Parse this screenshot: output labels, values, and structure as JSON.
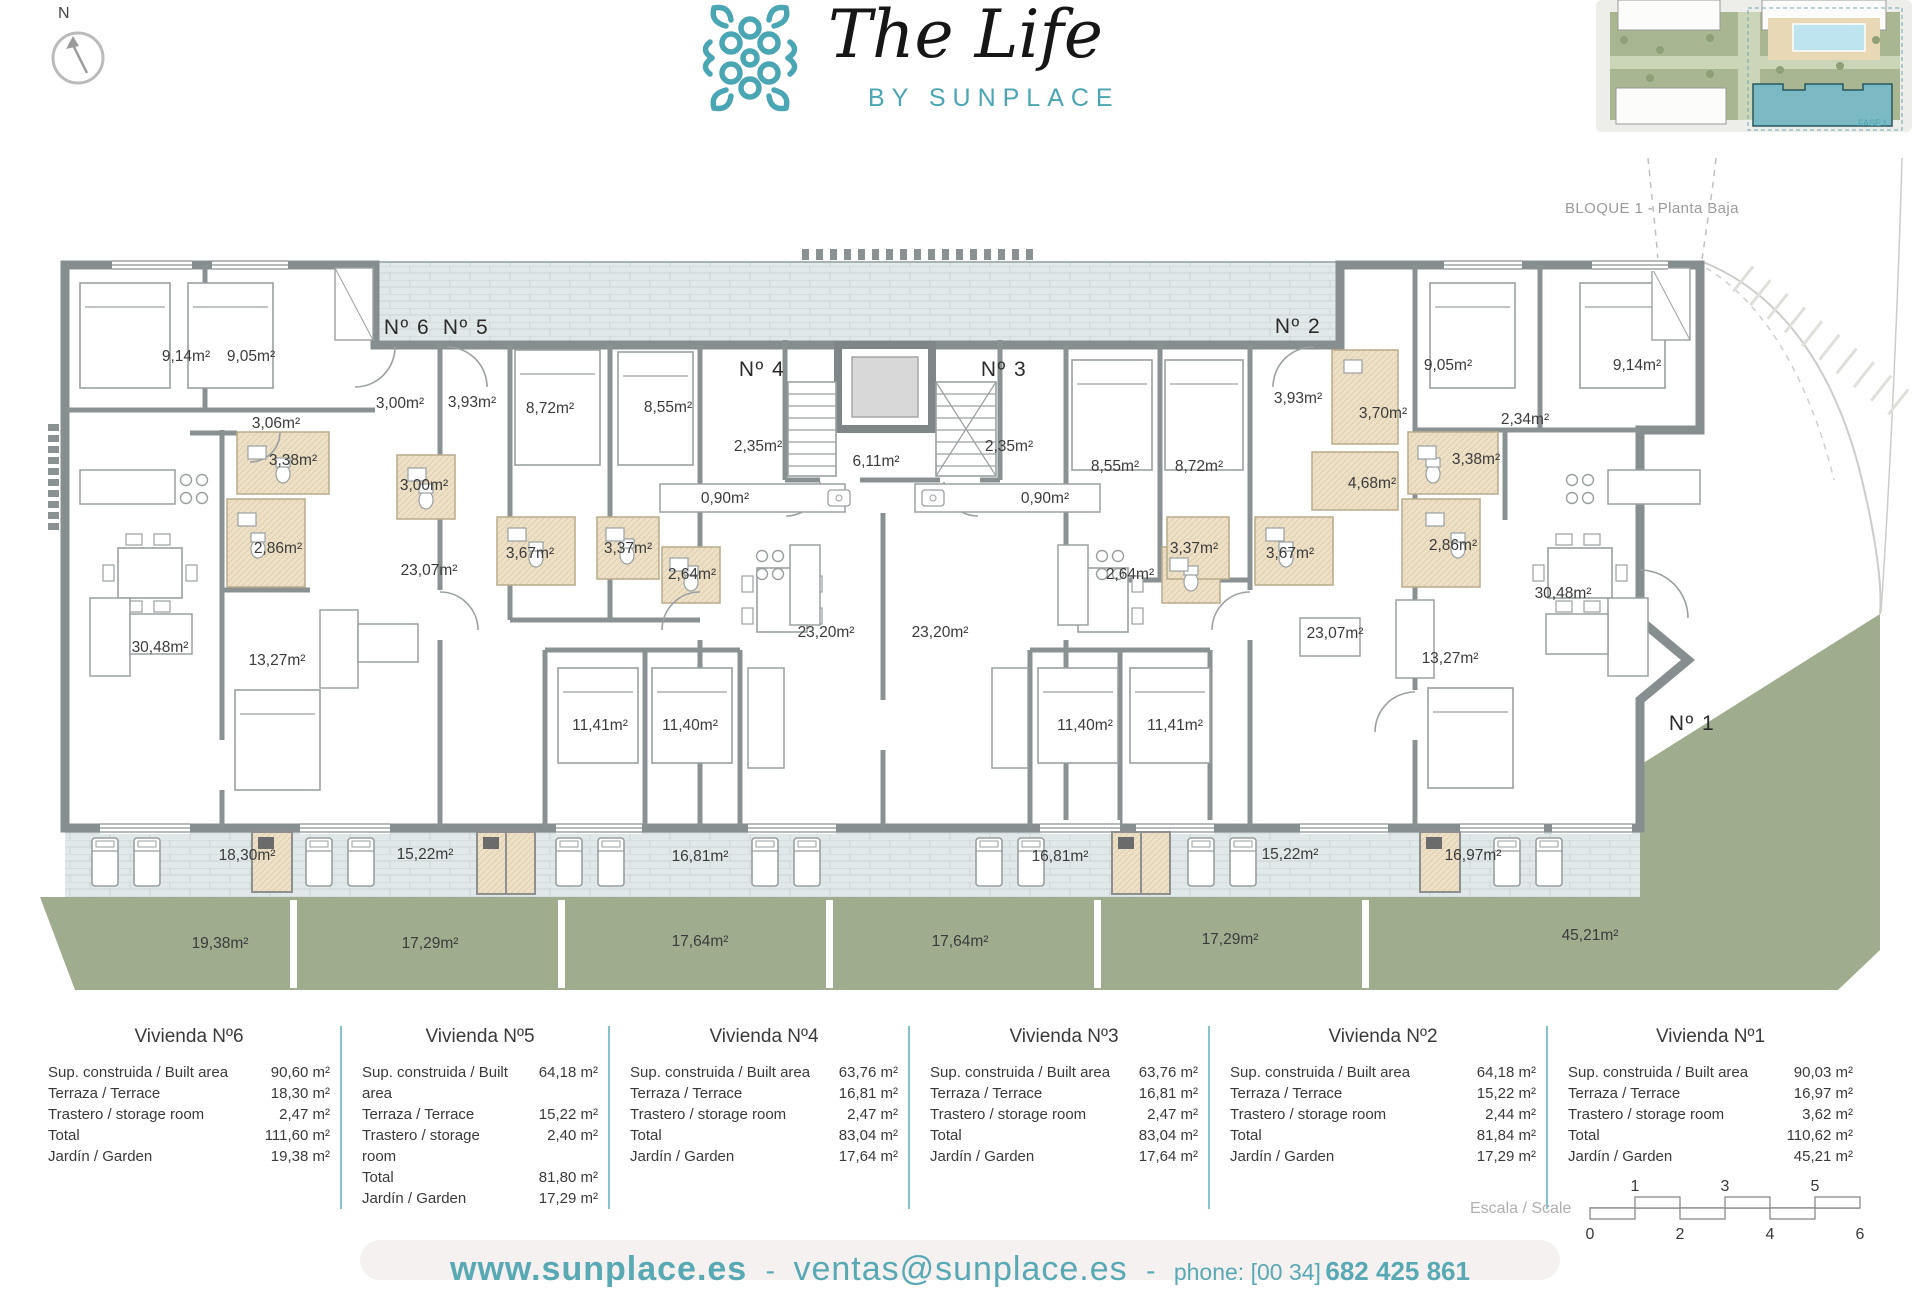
{
  "header": {
    "compass_label": "N",
    "logo_title": "The Life",
    "logo_subtitle": "BY SUNPLACE",
    "inset_caption": "BLOQUE 1 - Planta Baja",
    "inset_fase_label": "FASE I"
  },
  "plan": {
    "unit_labels": [
      {
        "t": "Nº 6",
        "x": 407,
        "y": 334
      },
      {
        "t": "Nº 5",
        "x": 466,
        "y": 334
      },
      {
        "t": "Nº 4",
        "x": 762,
        "y": 376
      },
      {
        "t": "Nº 3",
        "x": 1004,
        "y": 376
      },
      {
        "t": "Nº 2",
        "x": 1298,
        "y": 333
      },
      {
        "t": "Nº 1",
        "x": 1692,
        "y": 730
      }
    ],
    "room_labels": [
      {
        "t": "9,14m²",
        "x": 186,
        "y": 361
      },
      {
        "t": "9,05m²",
        "x": 251,
        "y": 361
      },
      {
        "t": "3,06m²",
        "x": 276,
        "y": 428
      },
      {
        "t": "3,38m²",
        "x": 293,
        "y": 465
      },
      {
        "t": "2,86m²",
        "x": 278,
        "y": 553
      },
      {
        "t": "30,48m²",
        "x": 160,
        "y": 652
      },
      {
        "t": "13,27m²",
        "x": 277,
        "y": 665
      },
      {
        "t": "3,00m²",
        "x": 400,
        "y": 408
      },
      {
        "t": "3,93m²",
        "x": 472,
        "y": 407
      },
      {
        "t": "8,72m²",
        "x": 550,
        "y": 413
      },
      {
        "t": "8,55m²",
        "x": 668,
        "y": 412
      },
      {
        "t": "3,00m²",
        "x": 424,
        "y": 490
      },
      {
        "t": "23,07m²",
        "x": 429,
        "y": 575
      },
      {
        "t": "3,67m²",
        "x": 530,
        "y": 558
      },
      {
        "t": "3,37m²",
        "x": 628,
        "y": 553
      },
      {
        "t": "2,64m²",
        "x": 692,
        "y": 579
      },
      {
        "t": "11,41m²",
        "x": 600,
        "y": 730
      },
      {
        "t": "11,40m²",
        "x": 690,
        "y": 730
      },
      {
        "t": "2,35m²",
        "x": 758,
        "y": 451
      },
      {
        "t": "0,90m²",
        "x": 725,
        "y": 503
      },
      {
        "t": "6,11m²",
        "x": 876,
        "y": 466
      },
      {
        "t": "23,20m²",
        "x": 826,
        "y": 637
      },
      {
        "t": "2,35m²",
        "x": 1009,
        "y": 451
      },
      {
        "t": "0,90m²",
        "x": 1045,
        "y": 503
      },
      {
        "t": "23,20m²",
        "x": 940,
        "y": 637
      },
      {
        "t": "11,40m²",
        "x": 1085,
        "y": 730
      },
      {
        "t": "11,41m²",
        "x": 1175,
        "y": 730
      },
      {
        "t": "8,55m²",
        "x": 1115,
        "y": 471
      },
      {
        "t": "8,72m²",
        "x": 1199,
        "y": 471
      },
      {
        "t": "3,93m²",
        "x": 1298,
        "y": 403
      },
      {
        "t": "3,70m²",
        "x": 1383,
        "y": 418
      },
      {
        "t": "4,68m²",
        "x": 1372,
        "y": 488
      },
      {
        "t": "3,37m²",
        "x": 1194,
        "y": 553
      },
      {
        "t": "3,67m²",
        "x": 1290,
        "y": 558
      },
      {
        "t": "2,64m²",
        "x": 1130,
        "y": 579
      },
      {
        "t": "23,07m²",
        "x": 1335,
        "y": 638
      },
      {
        "t": "9,05m²",
        "x": 1448,
        "y": 370
      },
      {
        "t": "9,14m²",
        "x": 1637,
        "y": 370
      },
      {
        "t": "2,34m²",
        "x": 1525,
        "y": 424
      },
      {
        "t": "3,38m²",
        "x": 1476,
        "y": 464
      },
      {
        "t": "2,86m²",
        "x": 1453,
        "y": 550
      },
      {
        "t": "13,27m²",
        "x": 1450,
        "y": 663
      },
      {
        "t": "30,48m²",
        "x": 1563,
        "y": 598
      }
    ],
    "terrace_labels": [
      {
        "t": "18,30m²",
        "x": 247,
        "y": 860
      },
      {
        "t": "15,22m²",
        "x": 425,
        "y": 859
      },
      {
        "t": "16,81m²",
        "x": 700,
        "y": 861
      },
      {
        "t": "16,81m²",
        "x": 1060,
        "y": 861
      },
      {
        "t": "15,22m²",
        "x": 1290,
        "y": 859
      },
      {
        "t": "16,97m²",
        "x": 1473,
        "y": 860
      }
    ],
    "garden_labels": [
      {
        "t": "19,38m²",
        "x": 220,
        "y": 948
      },
      {
        "t": "17,29m²",
        "x": 430,
        "y": 948
      },
      {
        "t": "17,64m²",
        "x": 700,
        "y": 946
      },
      {
        "t": "17,64m²",
        "x": 960,
        "y": 946
      },
      {
        "t": "17,29m²",
        "x": 1230,
        "y": 944
      },
      {
        "t": "45,21m²",
        "x": 1590,
        "y": 940
      }
    ]
  },
  "summary": {
    "row_labels": [
      "Sup. construida / Built area",
      "Terraza / Terrace",
      "Trastero / storage room",
      "Total",
      "Jardín / Garden"
    ],
    "units": [
      {
        "title": "Vivienda Nº6",
        "values": [
          "90,60 m²",
          "18,30 m²",
          "2,47 m²",
          "111,60 m²",
          "19,38 m²"
        ]
      },
      {
        "title": "Vivienda Nº5",
        "values": [
          "64,18 m²",
          "15,22 m²",
          "2,40 m²",
          "81,80 m²",
          "17,29 m²"
        ]
      },
      {
        "title": "Vivienda Nº4",
        "values": [
          "63,76 m²",
          "16,81 m²",
          "2,47 m²",
          "83,04 m²",
          "17,64 m²"
        ]
      },
      {
        "title": "Vivienda Nº3",
        "values": [
          "63,76 m²",
          "16,81 m²",
          "2,47 m²",
          "83,04 m²",
          "17,64 m²"
        ]
      },
      {
        "title": "Vivienda Nº2",
        "values": [
          "64,18 m²",
          "15,22 m²",
          "2,44 m²",
          "81,84 m²",
          "17,29 m²"
        ]
      },
      {
        "title": "Vivienda Nº1",
        "values": [
          "90,03 m²",
          "16,97 m²",
          "3,62 m²",
          "110,62 m²",
          "45,21 m²"
        ]
      }
    ]
  },
  "scale": {
    "label": "Escala / Scale",
    "top_ticks": [
      "1",
      "3",
      "5"
    ],
    "bottom_ticks": [
      "0",
      "2",
      "4",
      "6"
    ]
  },
  "footer": {
    "website": "www.sunplace.es",
    "separator": "-",
    "email": "ventas@sunplace.es",
    "phone_label": "phone: [00 34]",
    "phone_number": "682 425 861"
  },
  "colors": {
    "brand_teal": "#4BA6B3",
    "wall_gray": "#868E8F",
    "paving": "#E1E8E9",
    "garden_green": "#9FAD8E",
    "bath_tan": "#EDE0C6",
    "label_text": "#3B3B3B",
    "caption_gray": "#9B9B9B"
  }
}
